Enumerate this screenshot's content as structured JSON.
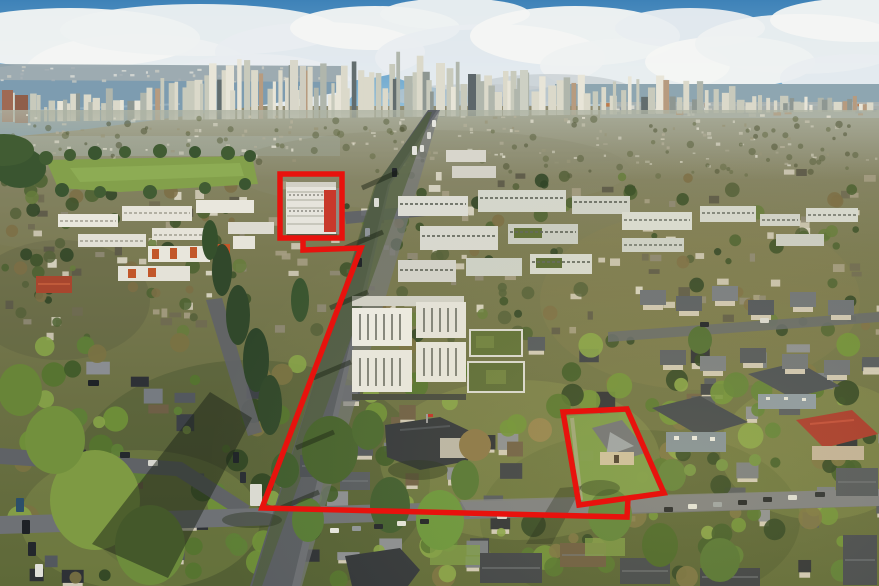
{
  "scene": {
    "type": "aerial-photograph",
    "description": "Aerial drone photo of a Vancouver residential neighbourhood looking north toward the downtown skyline, Burrard Inlet and cloud-covered North Shore mountains. A red outline annotation highlights a property assembly: a mid-rise apartment building near the Cambie Street corridor, a boundary line running diagonally along a tree-lined street then east along an avenue, and a single-family corner parcel with a gabled house.",
    "overlay": "red property boundary annotation"
  },
  "palette": {
    "sky_top": "#3e82b8",
    "sky_bottom": "#b9d7e6",
    "cloud_white": "#f4f5f3",
    "cloud_shadow": "#b9c1c6",
    "mountain": "#36535f",
    "mountain_foot": "#2c4450",
    "snow": "#dfe7ec",
    "water": "#7d9cb0",
    "harbour": "#8ea6b1",
    "far_shore": "#96a5ab",
    "tower_light": "#e8e5d8",
    "tower_dark": "#626d6e",
    "tower_brick": "#9f6a54",
    "city_haze": "#aeb3a3",
    "city_top": "#8f8c72",
    "city_bottom": "#5e6938",
    "road": "#595d62",
    "road_main": "#6e7175",
    "road_sunlit": "#7e8184",
    "park_green": "#83a04b",
    "lawn": "#7a9a48",
    "conifer": "#31482b",
    "tree_bright": "#7e9a43",
    "tree_autumn": "#7c6f45",
    "building_white": "#e6e4dc",
    "hero_red_accent": "#c8392b",
    "accent_orange": "#c2572a",
    "roof_dark": "#33373c",
    "roof_red": "#a6382b",
    "shadow": "#1c2417",
    "boundary_red": "#e8120d"
  },
  "boundary": {
    "color": "#e8120d",
    "stroke_width": 5.5,
    "building_box_points": "280,174 342,174 342,238 280,238",
    "connector_points": "303,239 303,250 361,248 262,508 627,517 628,498",
    "parcel_points": "563,412 627,409 664,493 579,505"
  }
}
